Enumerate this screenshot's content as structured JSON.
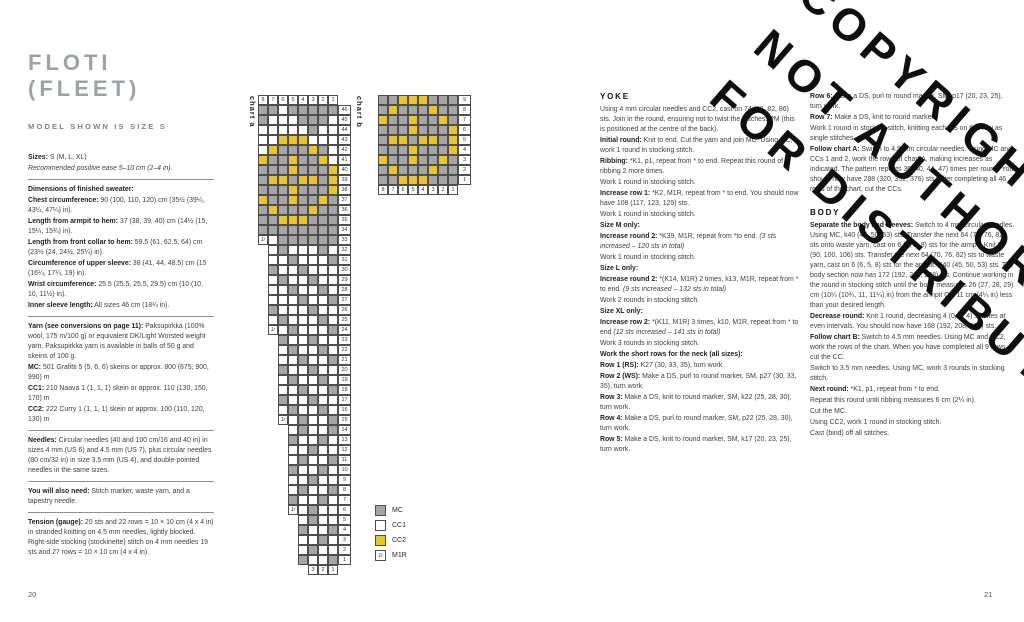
{
  "page_numbers": {
    "left": "20",
    "right": "21"
  },
  "colors": {
    "mc_gray": "#a5a5a5",
    "cc2_yellow": "#e9c42e",
    "title_gray": "#9ba3a5"
  },
  "header": {
    "title": "FLOTI (FLEET)",
    "model_line": "MODEL SHOWN IS SIZE S"
  },
  "watermark": {
    "lines": [
      "COPYRIGHTED",
      "NOT AUTHORIZED",
      "FOR DISTRIBUTION"
    ]
  },
  "left_column": {
    "blocks": [
      {
        "type": "p",
        "segs": [
          {
            "t": "Sizes:",
            "b": true
          },
          {
            "t": " S (M, L, XL)"
          }
        ]
      },
      {
        "type": "p",
        "segs": [
          {
            "t": "Recommended positive ease 5–10 cm (2–4 in).",
            "i": true
          }
        ]
      },
      {
        "type": "rule"
      },
      {
        "type": "p",
        "segs": [
          {
            "t": "Dimensions of finished sweater:",
            "b": true
          }
        ]
      },
      {
        "type": "p",
        "segs": [
          {
            "t": "Chest circumference:",
            "b": true
          },
          {
            "t": " 90 (100, 110, 120) cm (35½ (39¼, 43¼, 47¼) in)."
          }
        ]
      },
      {
        "type": "p",
        "segs": [
          {
            "t": "Length from armpit to hem:",
            "b": true
          },
          {
            "t": " 37 (38, 39, 40) cm (14½ (15, 15¼, 15¾) in)."
          }
        ]
      },
      {
        "type": "p",
        "segs": [
          {
            "t": "Length from front collar to hem:",
            "b": true
          },
          {
            "t": " 59.5 (61, 62.5, 64) cm (23½ (24, 24½, 25¼) in)."
          }
        ]
      },
      {
        "type": "p",
        "segs": [
          {
            "t": "Circumference of upper sleeve:",
            "b": true
          },
          {
            "t": " 38 (41, 44, 48.5) cm (15 (16¼, 17¼, 19) in)."
          }
        ]
      },
      {
        "type": "p",
        "segs": [
          {
            "t": "Wrist circumference:",
            "b": true
          },
          {
            "t": " 25.5 (25.5, 25.5, 29.5) cm (10 (10, 10, 11½) in)."
          }
        ]
      },
      {
        "type": "p",
        "segs": [
          {
            "t": "Inner sleeve length:",
            "b": true
          },
          {
            "t": " All sizes 46 cm (18¼ in)."
          }
        ]
      },
      {
        "type": "rule"
      },
      {
        "type": "p",
        "segs": [
          {
            "t": "Yarn (see conversions on page 11):",
            "b": true
          },
          {
            "t": " Paksupirkka (100% wool, 175 m/100 g) or equivalent DK/Light Worsted weight yarn. Paksupirkka yarn is available in balls of 50 g and skeins of 100 g."
          }
        ]
      },
      {
        "type": "p",
        "segs": [
          {
            "t": "MC:",
            "b": true
          },
          {
            "t": " 501 Grafitti 5 (5, 6, 6) skeins or approx. 800 (875, 900, 990) m"
          }
        ]
      },
      {
        "type": "p",
        "segs": [
          {
            "t": "CC1:",
            "b": true
          },
          {
            "t": " 210 Naava 1 (1, 1, 1) skein or approx. 110 (130, 150, 170) m"
          }
        ]
      },
      {
        "type": "p",
        "segs": [
          {
            "t": "CC2:",
            "b": true
          },
          {
            "t": " 222 Curry 1 (1, 1, 1) skein or approx. 100 (110, 120, 130) m"
          }
        ]
      },
      {
        "type": "rule"
      },
      {
        "type": "p",
        "segs": [
          {
            "t": "Needles:",
            "b": true
          },
          {
            "t": " Circular needles (40 and 100 cm/16 and 40 in) in sizes 4 mm (US 6) and 4.5 mm (US 7), plus circular needles (80 cm/32 in) in size 3.5 mm (US 4), and double-pointed needles in the same sizes."
          }
        ]
      },
      {
        "type": "rule"
      },
      {
        "type": "p",
        "segs": [
          {
            "t": "You will also need:",
            "b": true
          },
          {
            "t": " Stitch marker, waste yarn, and a tapestry needle."
          }
        ]
      },
      {
        "type": "rule"
      },
      {
        "type": "p",
        "segs": [
          {
            "t": "Tension (gauge):",
            "b": true
          },
          {
            "t": " 20 sts and 22 rows = 10 × 10 cm (4 x 4 in) in stranded knitting on 4.5 mm needles, lightly blocked. Right-side stocking (stockinette) stitch on 4 mm needles 19 sts and 27 rows = 10 × 10 cm (4 x 4 in)."
          }
        ]
      }
    ]
  },
  "yoke_column": {
    "blocks": [
      {
        "type": "h",
        "text": "YOKE"
      },
      {
        "type": "p",
        "segs": [
          {
            "t": "Using 4 mm circular needles and CC2, cast on 74 (78, 82, 86) sts. Join in the round, ensuring not to twist the stitches. PM (this is positioned at the centre of the back)."
          }
        ]
      },
      {
        "type": "p",
        "segs": [
          {
            "t": "Initial round:",
            "b": true
          },
          {
            "t": " Knit to end. Cut the yarn and join MC. Using MC, work 1 round in stocking stitch."
          }
        ]
      },
      {
        "type": "p",
        "segs": [
          {
            "t": "Ribbing:",
            "b": true
          },
          {
            "t": " *K1, p1, repeat from * to end. Repeat this round of ribbing 2 more times."
          }
        ]
      },
      {
        "type": "p",
        "segs": [
          {
            "t": "Work 1 round in stocking stitch."
          }
        ]
      },
      {
        "type": "p",
        "segs": [
          {
            "t": "Increase row 1:",
            "b": true
          },
          {
            "t": " *K2, M1R, repeat from * to end. You should now have 108 (117, 123, 129) sts."
          }
        ]
      },
      {
        "type": "p",
        "segs": [
          {
            "t": "Work 1 round in stocking stitch."
          }
        ]
      },
      {
        "type": "p",
        "segs": [
          {
            "t": "Size M only:",
            "b": true
          }
        ]
      },
      {
        "type": "p",
        "segs": [
          {
            "t": "Increase round 2:",
            "b": true
          },
          {
            "t": " *K39, M1R, repeat from *to end. "
          },
          {
            "t": "(3 sts increased – 120 sts in total)",
            "i": true
          }
        ]
      },
      {
        "type": "p",
        "segs": [
          {
            "t": "Work 1 round in stocking stitch."
          }
        ]
      },
      {
        "type": "p",
        "segs": [
          {
            "t": "Size L only:",
            "b": true
          }
        ]
      },
      {
        "type": "p",
        "segs": [
          {
            "t": "Increase round 2:",
            "b": true
          },
          {
            "t": " *(K14, M1R) 2 times, k13, M1R, repeat from * to end. "
          },
          {
            "t": "(9 sts increased – 132 sts in total)",
            "i": true
          }
        ]
      },
      {
        "type": "p",
        "segs": [
          {
            "t": "Work 2 rounds in stocking stitch."
          }
        ]
      },
      {
        "type": "p",
        "segs": [
          {
            "t": "Size XL only:",
            "b": true
          }
        ]
      },
      {
        "type": "p",
        "segs": [
          {
            "t": "Increase row 2:",
            "b": true
          },
          {
            "t": " *(K11, M1R) 3 times, k10, M1R, repeat from * to end "
          },
          {
            "t": "(12 sts increased – 141 sts in total)",
            "i": true
          }
        ]
      },
      {
        "type": "p",
        "segs": [
          {
            "t": "Work 3 rounds in stocking stitch."
          }
        ]
      },
      {
        "type": "p",
        "segs": [
          {
            "t": "Work the short rows for the neck (all sizes):",
            "b": true
          }
        ]
      },
      {
        "type": "p",
        "segs": [
          {
            "t": "Row 1 (RS):",
            "b": true
          },
          {
            "t": " K27 (30, 33, 35), turn work."
          }
        ]
      },
      {
        "type": "p",
        "segs": [
          {
            "t": "Row 2 (WS):",
            "b": true
          },
          {
            "t": " Make a DS, purl to round marker, SM, p27 (30, 33, 35), turn work."
          }
        ]
      },
      {
        "type": "p",
        "segs": [
          {
            "t": "Row 3:",
            "b": true
          },
          {
            "t": " Make a DS, knit to round marker, SM, k22 (25, 28, 30), turn work."
          }
        ]
      },
      {
        "type": "p",
        "segs": [
          {
            "t": "Row 4:",
            "b": true
          },
          {
            "t": " Make a DS, purl to round marker, SM, p22 (25, 28, 30), turn work."
          }
        ]
      },
      {
        "type": "p",
        "segs": [
          {
            "t": "Row 5:",
            "b": true
          },
          {
            "t": " Make a DS, knit to round marker, SM, k17 (20, 23, 25), turn work."
          }
        ]
      }
    ]
  },
  "body_column": {
    "blocks": [
      {
        "type": "p",
        "segs": [
          {
            "t": "Row 6:",
            "b": true
          },
          {
            "t": " Make a DS, purl to round marker, SM, p17 (20, 23, 25), turn work."
          }
        ]
      },
      {
        "type": "p",
        "segs": [
          {
            "t": "Row 7:",
            "b": true
          },
          {
            "t": " Make a DS, knit to round marker."
          }
        ]
      },
      {
        "type": "p",
        "segs": [
          {
            "t": "Work 1 round in stocking stitch, knitting each DS on this row as single stitches."
          }
        ]
      },
      {
        "type": "p",
        "segs": [
          {
            "t": "Follow chart A:",
            "b": true
          },
          {
            "t": " Switch to 4.5 mm circular needles. Using MC and CCs 1 and 2, work the rows of chart A, making increases as indicated. The pattern repeats 36 (40, 44, 47) times per round. You should now have 288 (320, 352, 376) sts. After completing all 46 rows of the chart, cut the CCs."
          }
        ]
      },
      {
        "type": "gap"
      },
      {
        "type": "h",
        "text": "BODY"
      },
      {
        "type": "p",
        "segs": [
          {
            "t": "Separate the body and sleeves:",
            "b": true
          },
          {
            "t": " Switch to 4 mm circular needles. Using MC, k40 (45, 50, 53) sts. Transfer the next 64 (70, 76, 82) sts onto waste yarn, cast on 6 (6, 5, 8) sts for the armpit. Knit 80 (90, 100, 106) sts. Transfer the next 64 (70, 76, 82) sts to waste yarn, cast on 6 (6, 5, 8) sts for the armpit. K40 (45, 50, 53) sts. The body section now has 172 (192, 210, 228) sts. Continue working in the round in stocking stitch until the body measures 26 (27, 28, 29) cm (10¼ (10¾, 11, 11¼) in) from the armpit OR 11 cm (4¼ in) less than your desired length."
          }
        ]
      },
      {
        "type": "p",
        "segs": [
          {
            "t": "Decrease round:",
            "b": true
          },
          {
            "t": " Knit 1 round, decreasing 4 (0, 2, 4) stitches at even intervals. You should now have 168 (192, 208, 224) sts."
          }
        ]
      },
      {
        "type": "p",
        "segs": [
          {
            "t": "Follow chart B:",
            "b": true
          },
          {
            "t": " Switch to 4.5 mm needles. Using MC and CC2, work the rows of the chart. When you have completed all 9 rows, cut the CC."
          }
        ]
      },
      {
        "type": "p",
        "segs": [
          {
            "t": "Switch to 3.5 mm needles. Using MC, work 3 rounds in stocking stitch."
          }
        ]
      },
      {
        "type": "p",
        "segs": [
          {
            "t": "Next round:",
            "b": true
          },
          {
            "t": " *K1, p1, repeat from * to end."
          }
        ]
      },
      {
        "type": "p",
        "segs": [
          {
            "t": "Repeat this round until ribbing measures 6 cm (2¼ in)."
          }
        ]
      },
      {
        "type": "p",
        "segs": [
          {
            "t": "Cut the MC."
          }
        ]
      },
      {
        "type": "p",
        "segs": [
          {
            "t": "Using CC2, work 1 round in stocking stitch."
          }
        ]
      },
      {
        "type": "p",
        "segs": [
          {
            "t": "Cast (bind) off all stitches."
          }
        ]
      }
    ]
  },
  "m1r_glyph": "1r",
  "chart_data": [
    {
      "type": "heatmap",
      "id": "chart_a",
      "label": "chart a",
      "legend_note": "G = MC (gray), W = CC1 (white), Y = CC2 (yellow), M = M1R increase cell",
      "top_numbers": [
        "8",
        "7",
        "6",
        "5",
        "4",
        "3",
        "2",
        "1"
      ],
      "bottom_numbers": [
        "3",
        "2",
        "1"
      ],
      "rows": [
        {
          "n": "46",
          "c": "GGWGGGGG"
        },
        {
          "n": "45",
          "c": "GWWWGGGW"
        },
        {
          "n": "44",
          "c": "WWWWWGWW"
        },
        {
          "n": "43",
          "c": "WWYYYWWW"
        },
        {
          "n": "42",
          "c": "WYGGGYGW"
        },
        {
          "n": "41",
          "c": "YGGYGGYW"
        },
        {
          "n": "40",
          "c": "GGGYGGGY"
        },
        {
          "n": "39",
          "c": "GYYGYYGY"
        },
        {
          "n": "38",
          "c": "GGGYGGGY"
        },
        {
          "n": "37",
          "c": "YGGYGGYG"
        },
        {
          "n": "36",
          "c": "GYGGGYGG"
        },
        {
          "n": "35",
          "c": "GGYYYGGG"
        },
        {
          "n": "34",
          "c": "GGGGGGGG"
        },
        {
          "n": "33",
          "c": "MWGGGGGG"
        },
        {
          "n": "32",
          "c": "WGWWWGW"
        },
        {
          "n": "31",
          "c": "WWGWWWG"
        },
        {
          "n": "30",
          "c": "GWWGWWW"
        },
        {
          "n": "29",
          "c": "WGWWGWW"
        },
        {
          "n": "28",
          "c": "WWGWWGW"
        },
        {
          "n": "27",
          "c": "WWWGWWG"
        },
        {
          "n": "26",
          "c": "GWWWGWW"
        },
        {
          "n": "25",
          "c": "WGWWWGW"
        },
        {
          "n": "24",
          "c": "MWGWWWG"
        },
        {
          "n": "23",
          "c": "GWWGWW"
        },
        {
          "n": "22",
          "c": "WGWWGW"
        },
        {
          "n": "21",
          "c": "WWGWWG"
        },
        {
          "n": "20",
          "c": "GWWGWW"
        },
        {
          "n": "19",
          "c": "WGWWGW"
        },
        {
          "n": "18",
          "c": "WWGWWG"
        },
        {
          "n": "17",
          "c": "GWWGWW"
        },
        {
          "n": "16",
          "c": "WGWWGW"
        },
        {
          "n": "15",
          "c": "MWGWWG"
        },
        {
          "n": "14",
          "c": "WGWWG"
        },
        {
          "n": "13",
          "c": "GWWGW"
        },
        {
          "n": "12",
          "c": "WWGWW"
        },
        {
          "n": "11",
          "c": "WGWWG"
        },
        {
          "n": "10",
          "c": "GWWGW"
        },
        {
          "n": "9",
          "c": "WWGWW"
        },
        {
          "n": "8",
          "c": "WGWWG"
        },
        {
          "n": "7",
          "c": "GWWGW"
        },
        {
          "n": "6",
          "c": "MWGWW"
        },
        {
          "n": "5",
          "c": "WGWW"
        },
        {
          "n": "4",
          "c": "GWWG"
        },
        {
          "n": "3",
          "c": "WWGW"
        },
        {
          "n": "2",
          "c": "WGWW"
        },
        {
          "n": "1",
          "c": "GWWG"
        }
      ]
    },
    {
      "type": "heatmap",
      "id": "chart_b",
      "label": "chart b",
      "bottom_numbers": [
        "8",
        "7",
        "6",
        "5",
        "4",
        "3",
        "2",
        "1"
      ],
      "rows": [
        {
          "n": "9",
          "c": "GGYYYGGG"
        },
        {
          "n": "8",
          "c": "GYGGGYGG"
        },
        {
          "n": "7",
          "c": "YGGYGGYG"
        },
        {
          "n": "6",
          "c": "GGGYGGGY"
        },
        {
          "n": "5",
          "c": "GYYGYYGY"
        },
        {
          "n": "4",
          "c": "GGGYGGGY"
        },
        {
          "n": "3",
          "c": "YGGYGGYG"
        },
        {
          "n": "2",
          "c": "GYGGGYGG"
        },
        {
          "n": "1",
          "c": "GGYYYGGG"
        }
      ]
    }
  ],
  "legend": {
    "items": [
      {
        "key": "G",
        "label": "MC"
      },
      {
        "key": "W",
        "label": "CC1"
      },
      {
        "key": "Y",
        "label": "CC2"
      },
      {
        "key": "M",
        "label": "M1R"
      }
    ]
  }
}
